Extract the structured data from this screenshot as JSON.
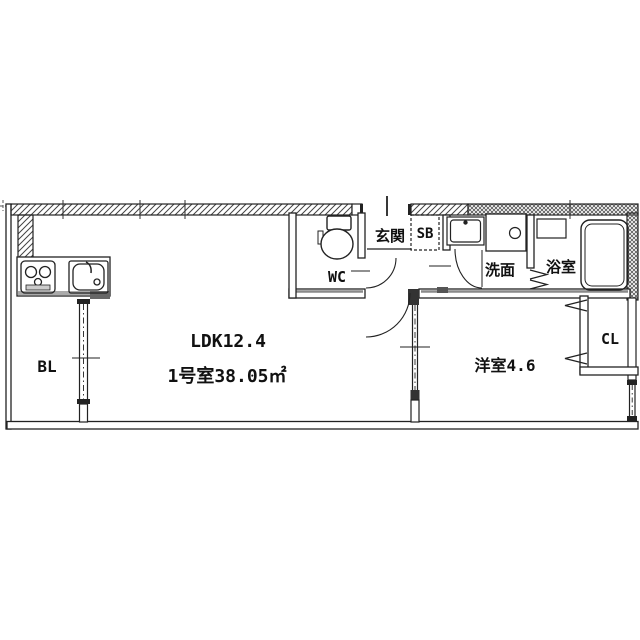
{
  "rooms": {
    "ldk": {
      "label": "LDK12.4"
    },
    "unit": {
      "label": "1号室38.05㎡"
    },
    "balcony": {
      "label": "BL"
    },
    "toilet": {
      "label": "WC"
    },
    "entrance": {
      "label": "玄関"
    },
    "shoe_box": {
      "label": "SB"
    },
    "washroom": {
      "label": "洗面"
    },
    "bathroom": {
      "label": "浴室"
    },
    "western_room": {
      "label": "洋室4.6"
    },
    "closet": {
      "label": "CL"
    }
  },
  "fixtures": {
    "stove": "gas-stove-2-burner-icon",
    "sink": "kitchen-sink-icon",
    "toilet": "toilet-icon",
    "vanity": "wash-basin-icon",
    "washer_pan": "washing-machine-pan-icon",
    "bath_counter": "bath-counter-icon",
    "bathtub": "bathtub-icon"
  },
  "colors": {
    "line": "#222222",
    "wall_shade": "#8a8a8a",
    "counter_shade": "#aaaaaa",
    "background": "#ffffff"
  }
}
